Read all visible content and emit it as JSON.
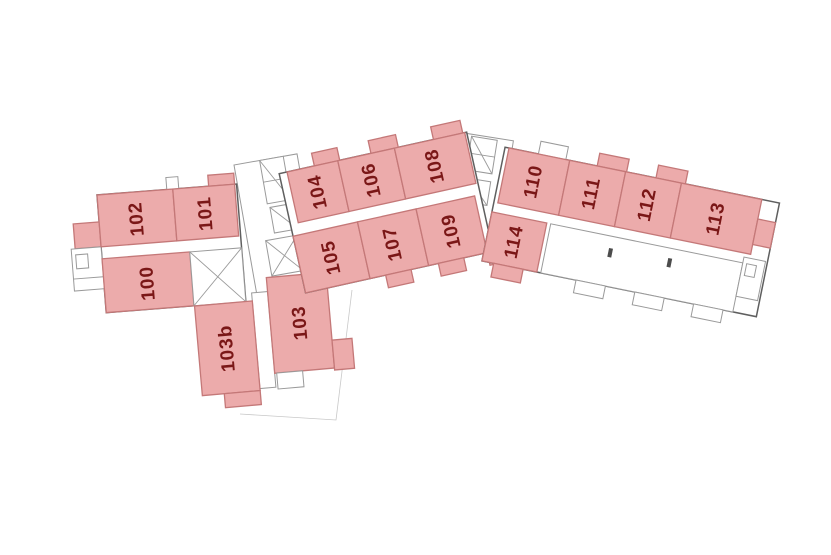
{
  "plan": {
    "rooms": {
      "r100": {
        "label": "100"
      },
      "r101": {
        "label": "101"
      },
      "r102": {
        "label": "102"
      },
      "r103": {
        "label": "103"
      },
      "r103b": {
        "label": "103b"
      },
      "r104": {
        "label": "104"
      },
      "r105": {
        "label": "105"
      },
      "r106": {
        "label": "106"
      },
      "r107": {
        "label": "107"
      },
      "r108": {
        "label": "108"
      },
      "r109": {
        "label": "109"
      },
      "r110": {
        "label": "110"
      },
      "r111": {
        "label": "111"
      },
      "r112": {
        "label": "112"
      },
      "r113": {
        "label": "113"
      },
      "r114": {
        "label": "114"
      }
    }
  },
  "colors": {
    "room_fill": "#ecabab",
    "room_border": "#c47878",
    "room_label": "#7a1717",
    "wall_dark": "#5f5f5f",
    "wall_light": "#9a9a9a",
    "background": "#ffffff"
  }
}
